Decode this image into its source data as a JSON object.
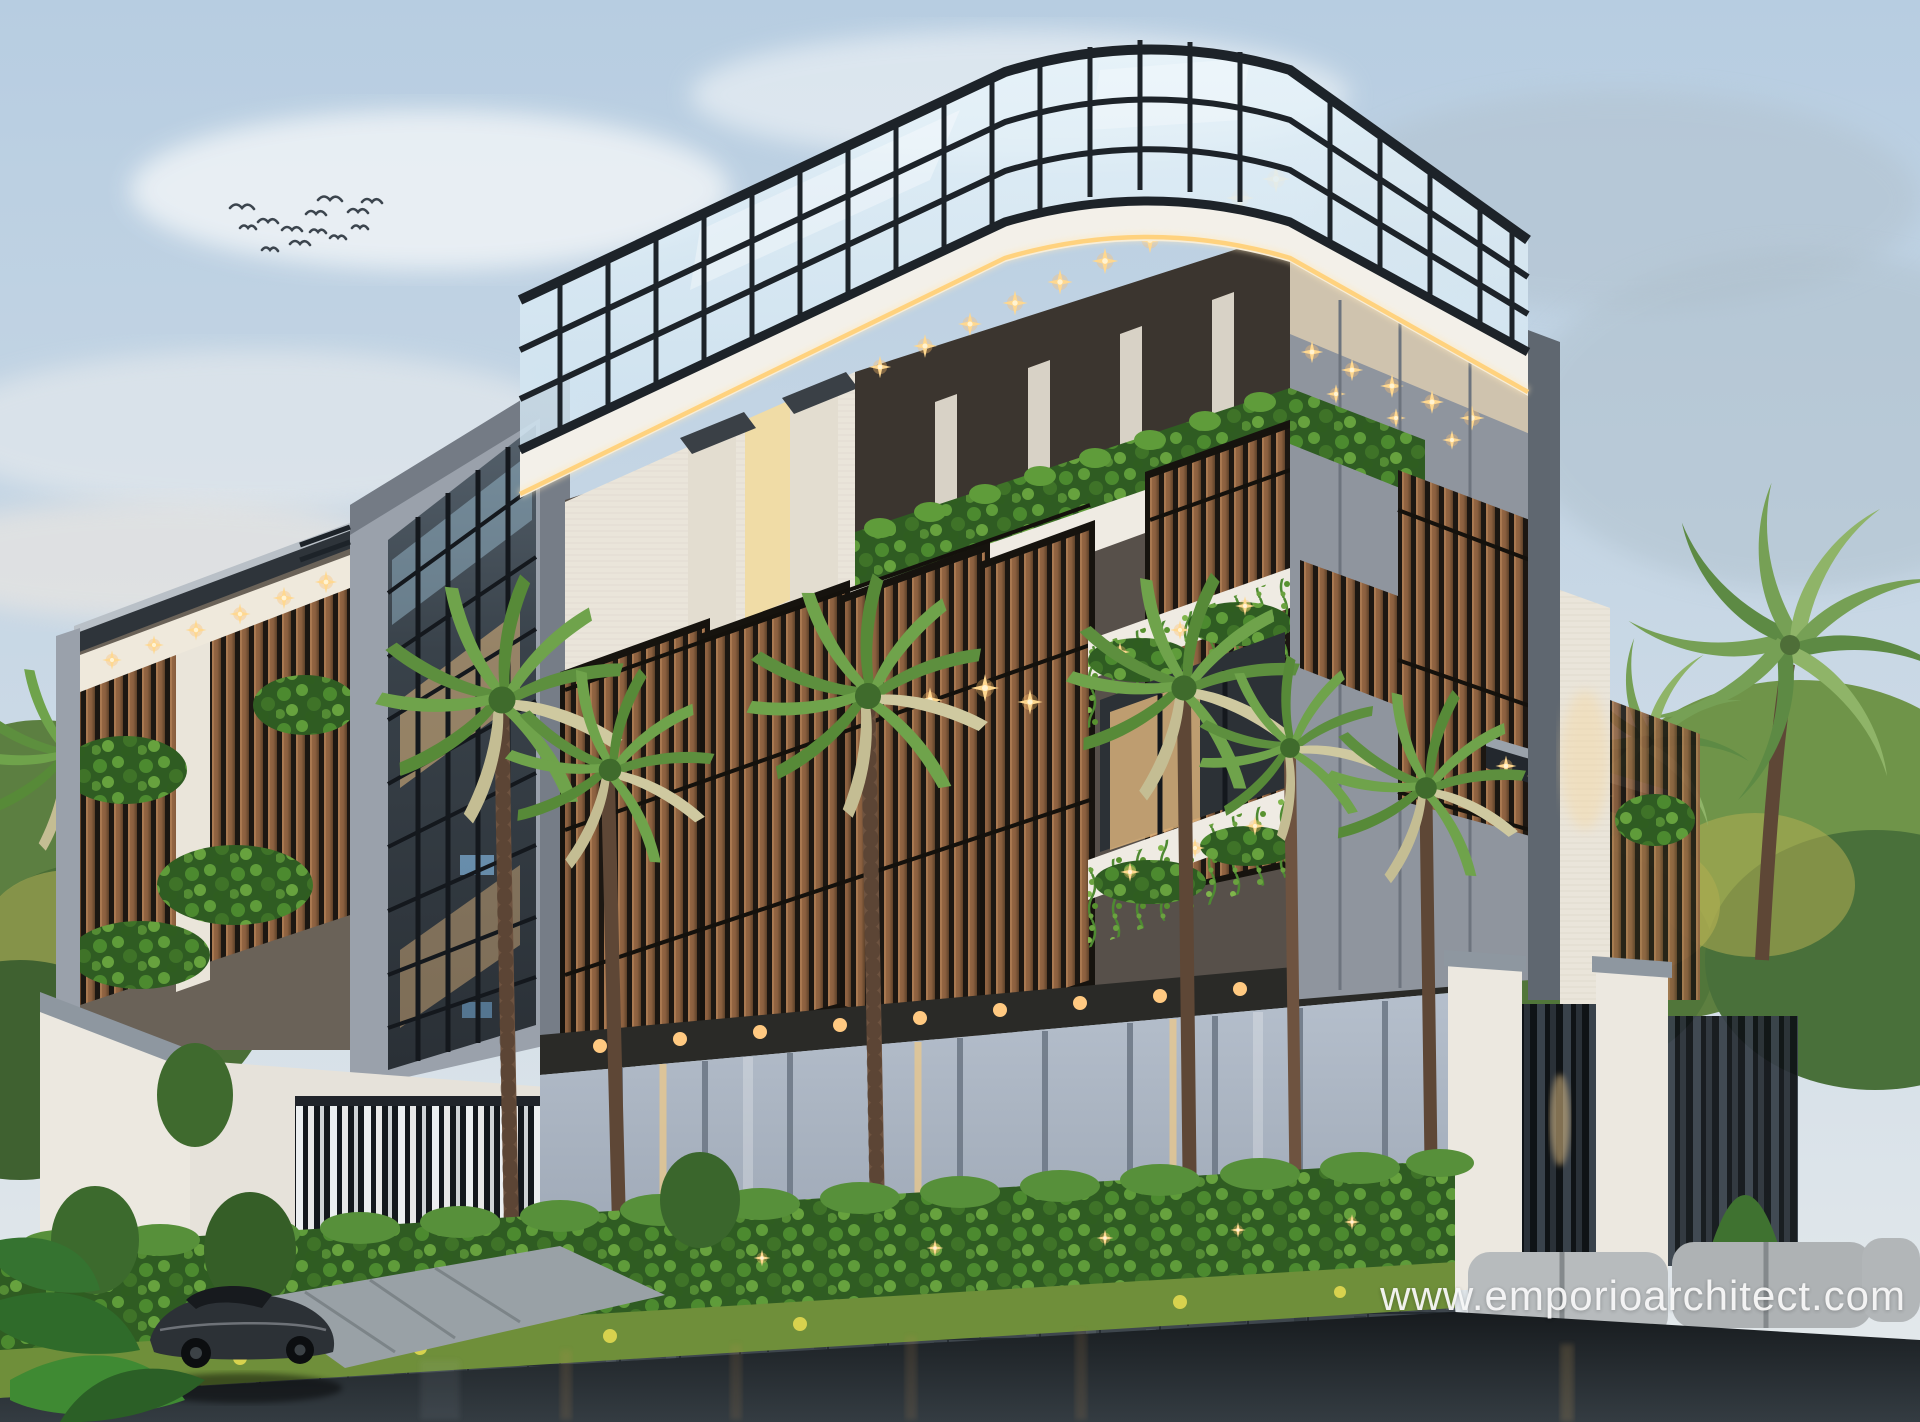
{
  "image": {
    "kind": "3D architectural exterior render, dusk lighting",
    "subject": "Modern 4-storey tropical building with rooftop glass pergola, wooden slat screens, hanging greenery, palm trees, front fence and wet street",
    "storeys_visible": 4,
    "birds_in_sky": 13
  },
  "watermark": {
    "text": "www.emporioarchitect.com",
    "color": "#f7f7f7"
  },
  "palette": {
    "sky_top": "#b7cde1",
    "sky_horizon": "#e6eaec",
    "cloud": "#f3f6f8",
    "mullion": "#1d2329",
    "glass": "#cfe3f0",
    "fascia": "#f3f0e9",
    "led": "#ffd27e",
    "stone_white": "#eae5da",
    "clad_light": "#9aa1ab",
    "clad_dark": "#5f6770",
    "wood": "#8a5f3f",
    "wood_dark": "#5d4129",
    "wood_gap": "#1c1712",
    "leaf": "#67a23e",
    "leaf_dark": "#2f5c22",
    "hedge": "#3b6a28",
    "interior_warm": "#e4b97f",
    "window_dark": "#2c3136",
    "fence": "#9aa4b2",
    "fence_dark": "#6b7684",
    "road": "#23282c",
    "planter": "#3e464d",
    "palm_trunk": "#6e5340",
    "grass": "#6f8f3a",
    "concrete": "#b7bbbd",
    "car": "#2c3136",
    "bird": "#3c454e",
    "watermark": "#f7f7f7"
  }
}
